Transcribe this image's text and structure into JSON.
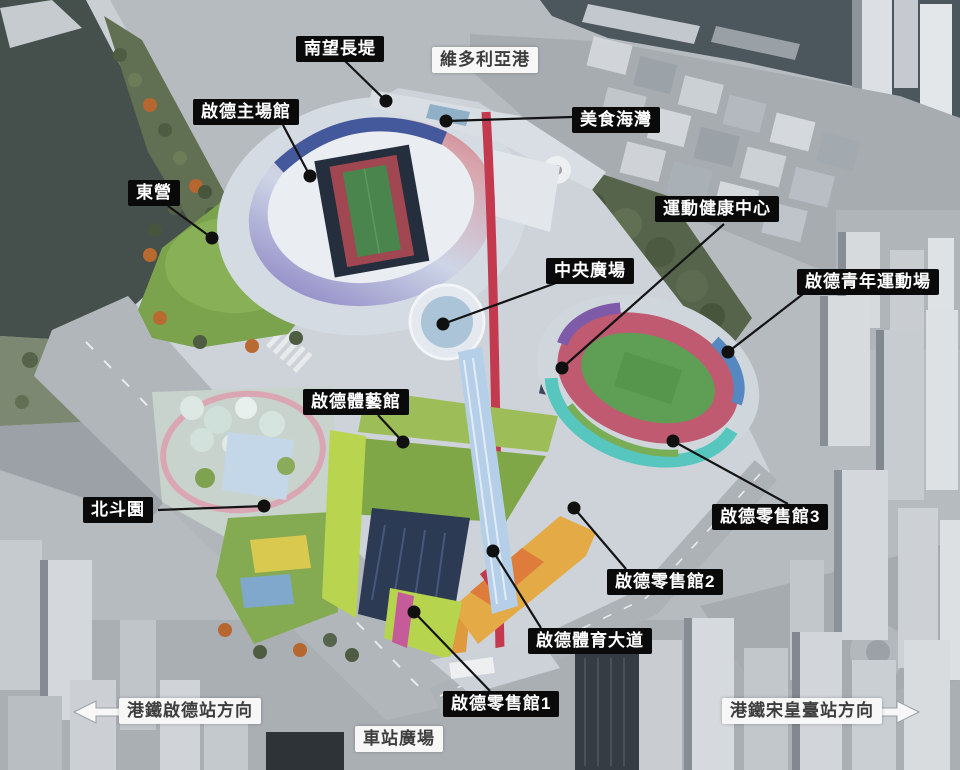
{
  "colors": {
    "leader_line": "#141414",
    "leader_dot": "#101010",
    "label_dark_bg": "#0a0a0a",
    "label_dark_text": "#ffffff",
    "label_light_bg": "#f7f7f7",
    "label_light_text": "#3d3d3d",
    "arrow_fill": "#f7f7f7",
    "arrow_outline": "#9aa0a5"
  },
  "map_labels": [
    {
      "id": "south-breakwater",
      "text": "南望長堤",
      "style": "dark",
      "box": {
        "x": 296,
        "y": 36
      },
      "line": {
        "x1": 345,
        "y1": 61,
        "x2": 386,
        "y2": 101
      },
      "dot": {
        "x": 386,
        "y": 101
      }
    },
    {
      "id": "victoria-harbour",
      "text": "維多利亞港",
      "style": "light",
      "box": {
        "x": 432,
        "y": 47
      }
    },
    {
      "id": "main-stadium",
      "text": "啟德主場館",
      "style": "dark",
      "box": {
        "x": 193,
        "y": 99
      },
      "line": {
        "x1": 283,
        "y1": 125,
        "x2": 310,
        "y2": 176
      },
      "dot": {
        "x": 310,
        "y": 176
      }
    },
    {
      "id": "dining-cove",
      "text": "美食海灣",
      "style": "dark",
      "box": {
        "x": 572,
        "y": 107
      },
      "line": {
        "x1": 572,
        "y1": 117,
        "x2": 446,
        "y2": 121
      },
      "dot": {
        "x": 446,
        "y": 121
      }
    },
    {
      "id": "east-lawn",
      "text": "東營",
      "style": "dark",
      "box": {
        "x": 128,
        "y": 180
      },
      "line": {
        "x1": 168,
        "y1": 206,
        "x2": 212,
        "y2": 238
      },
      "dot": {
        "x": 212,
        "y": 238
      }
    },
    {
      "id": "health-wellness-centre",
      "text": "運動健康中心",
      "style": "dark",
      "box": {
        "x": 655,
        "y": 196
      },
      "line": {
        "x1": 724,
        "y1": 224,
        "x2": 562,
        "y2": 368
      },
      "dot": {
        "x": 562,
        "y": 368
      }
    },
    {
      "id": "central-square",
      "text": "中央廣場",
      "style": "dark",
      "box": {
        "x": 546,
        "y": 258
      },
      "line": {
        "x1": 556,
        "y1": 283,
        "x2": 443,
        "y2": 324
      },
      "dot": {
        "x": 443,
        "y": 324
      }
    },
    {
      "id": "youth-sports-ground",
      "text": "啟德青年運動場",
      "style": "dark",
      "box": {
        "x": 797,
        "y": 269
      },
      "line": {
        "x1": 803,
        "y1": 294,
        "x2": 728,
        "y2": 352
      },
      "dot": {
        "x": 728,
        "y": 352
      }
    },
    {
      "id": "arena",
      "text": "啟德體藝館",
      "style": "dark",
      "box": {
        "x": 303,
        "y": 389
      },
      "line": {
        "x1": 378,
        "y1": 415,
        "x2": 403,
        "y2": 442
      },
      "dot": {
        "x": 403,
        "y": 442
      }
    },
    {
      "id": "dipper-garden",
      "text": "北斗園",
      "style": "dark",
      "box": {
        "x": 83,
        "y": 497
      },
      "line": {
        "x1": 158,
        "y1": 510,
        "x2": 264,
        "y2": 506
      },
      "dot": {
        "x": 264,
        "y": 506
      }
    },
    {
      "id": "retail-hall-3",
      "text": "啟德零售館3",
      "style": "dark",
      "box": {
        "x": 712,
        "y": 504
      },
      "line": {
        "x1": 788,
        "y1": 504,
        "x2": 673,
        "y2": 441
      },
      "dot": {
        "x": 673,
        "y": 441
      }
    },
    {
      "id": "retail-hall-2",
      "text": "啟德零售館2",
      "style": "dark",
      "box": {
        "x": 607,
        "y": 569
      },
      "line": {
        "x1": 626,
        "y1": 569,
        "x2": 574,
        "y2": 508
      },
      "dot": {
        "x": 574,
        "y": 508
      }
    },
    {
      "id": "sports-avenue",
      "text": "啟德體育大道",
      "style": "dark",
      "box": {
        "x": 528,
        "y": 628
      },
      "line": {
        "x1": 541,
        "y1": 628,
        "x2": 493,
        "y2": 551
      },
      "dot": {
        "x": 493,
        "y": 551
      }
    },
    {
      "id": "retail-hall-1",
      "text": "啟德零售館1",
      "style": "dark",
      "box": {
        "x": 443,
        "y": 691
      },
      "line": {
        "x1": 490,
        "y1": 691,
        "x2": 414,
        "y2": 612
      },
      "dot": {
        "x": 414,
        "y": 612
      }
    },
    {
      "id": "station-square",
      "text": "車站廣場",
      "style": "light",
      "box": {
        "x": 355,
        "y": 726
      }
    }
  ],
  "direction_signs": [
    {
      "id": "mtr-kai-tak-station",
      "text": "港鐵啟德站方向",
      "arrow": "left",
      "box": {
        "x": 119,
        "y": 698
      },
      "tip": {
        "x": 74,
        "y": 712
      }
    },
    {
      "id": "mtr-sung-wong-toi-station",
      "text": "港鐵宋皇臺站方向",
      "arrow": "right",
      "box": {
        "x": 722,
        "y": 698
      },
      "tip": {
        "x": 919,
        "y": 712
      }
    }
  ]
}
